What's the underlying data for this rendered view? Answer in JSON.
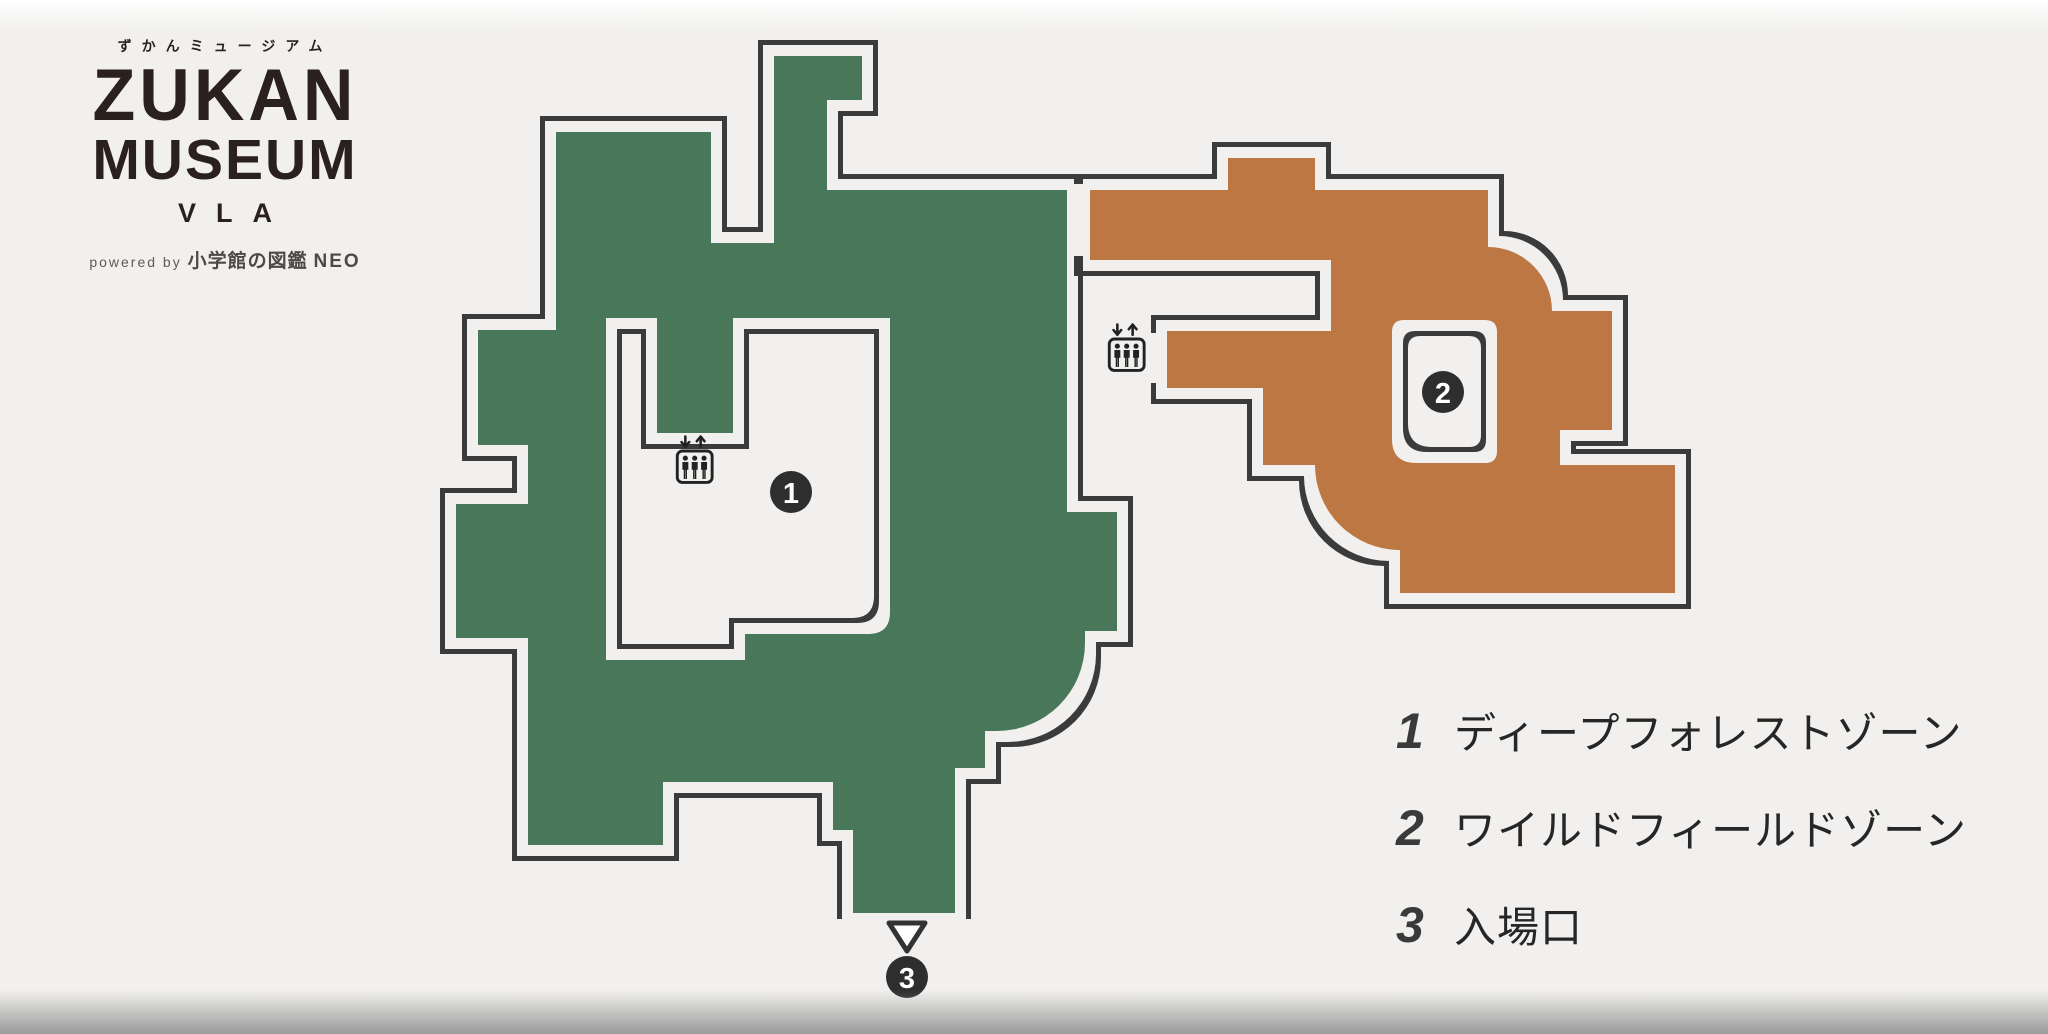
{
  "colors": {
    "background": "#f1f0ee",
    "deep_forest_green": "#487759",
    "wild_field_orange": "#bd7742",
    "outline": "#3a3a3a",
    "marker_bg": "#2e2e2e",
    "marker_text": "#ffffff",
    "logo_text": "#2a211e"
  },
  "branding": {
    "furigana": "ずかんミュージアム",
    "title_line1": "ZUKAN",
    "title_line2": "MUSEUM",
    "title_line3": "VLA",
    "powered_by_prefix": "powered by",
    "powered_by_brand": "小学館の図鑑",
    "powered_by_suffix": "NEO"
  },
  "map": {
    "zones": [
      {
        "id": "deep-forest-zone",
        "marker_number": "1"
      },
      {
        "id": "wild-field-zone",
        "marker_number": "2"
      }
    ],
    "markers": [
      {
        "number": "1"
      },
      {
        "number": "2"
      },
      {
        "number": "3"
      }
    ],
    "elevator_icon_count": 2
  },
  "legend": {
    "items": [
      {
        "number": "1",
        "label": "ディープフォレストゾーン"
      },
      {
        "number": "2",
        "label": "ワイルドフィールドゾーン"
      },
      {
        "number": "3",
        "label": "入場口"
      }
    ]
  }
}
